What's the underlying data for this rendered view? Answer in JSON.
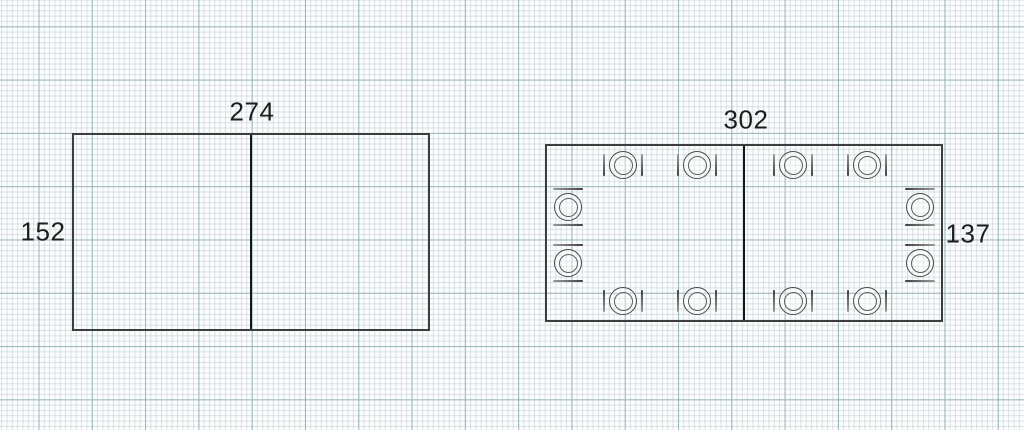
{
  "canvas": {
    "type": "floor-plan-grid-paper",
    "background_color": "#fbfcfc",
    "grid_minor_color": "#bac6ce",
    "grid_major_color": "#8dafb4",
    "grid_minor_step_px": 5.33,
    "grid_major_step_px": 53.3
  },
  "tables": [
    {
      "name": "rectangular-extension-table",
      "width_label": "274",
      "height_label": "152",
      "sections": 2,
      "place_settings": 0
    },
    {
      "name": "rectangular-extension-table-with-seats",
      "width_label": "302",
      "height_label": "137",
      "sections": 2,
      "place_settings": 10
    }
  ]
}
